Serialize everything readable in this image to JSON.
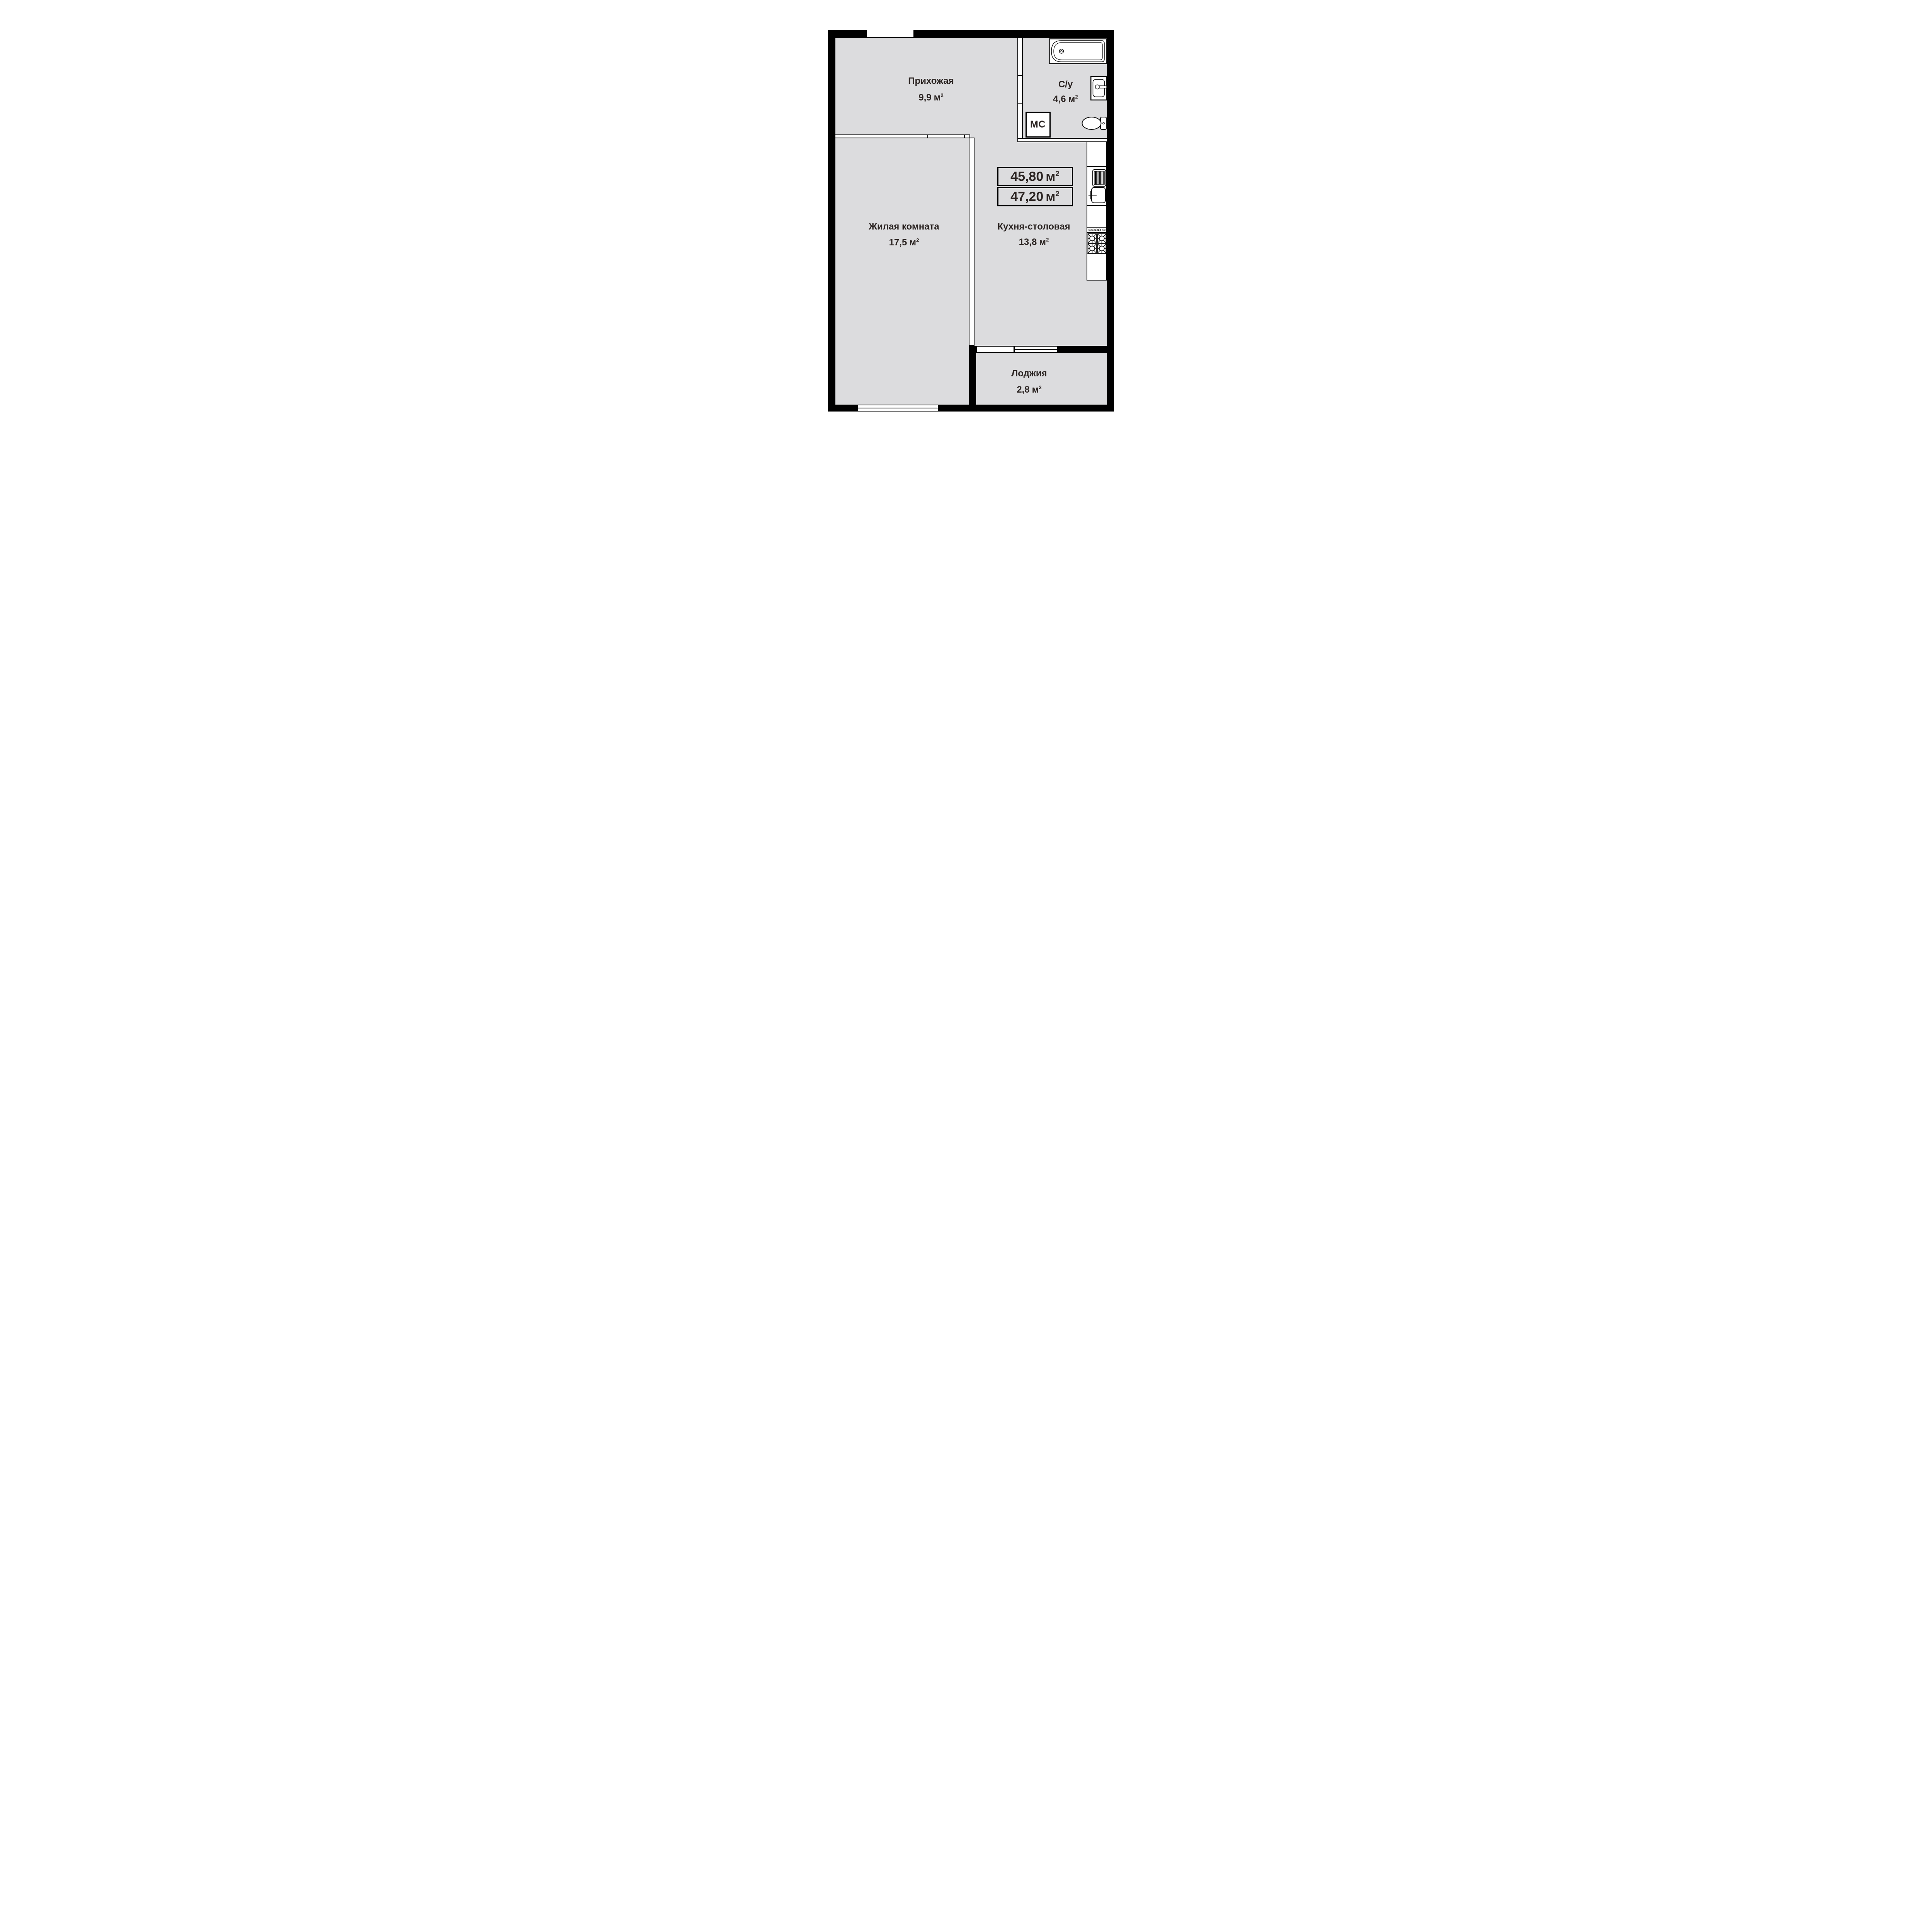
{
  "units": {
    "meter": "м",
    "sup": "2"
  },
  "totals": {
    "living_area": "45,80",
    "total_area": "47,20"
  },
  "rooms": [
    {
      "name": "Прихожая",
      "area": "9,9"
    },
    {
      "name": "С/у",
      "area": "4,6"
    },
    {
      "name": "Жилая комната",
      "area": "17,5"
    },
    {
      "name": "Кухня-столовая",
      "area": "13,8"
    },
    {
      "name": "Лоджия",
      "area": "2,8"
    }
  ],
  "labels": {
    "washing_machine": "МС"
  },
  "colors": {
    "floor": "#dcdcde",
    "wall": "#000000",
    "text": "#2b2422",
    "fixture_line": "#111111",
    "white": "#ffffff"
  }
}
